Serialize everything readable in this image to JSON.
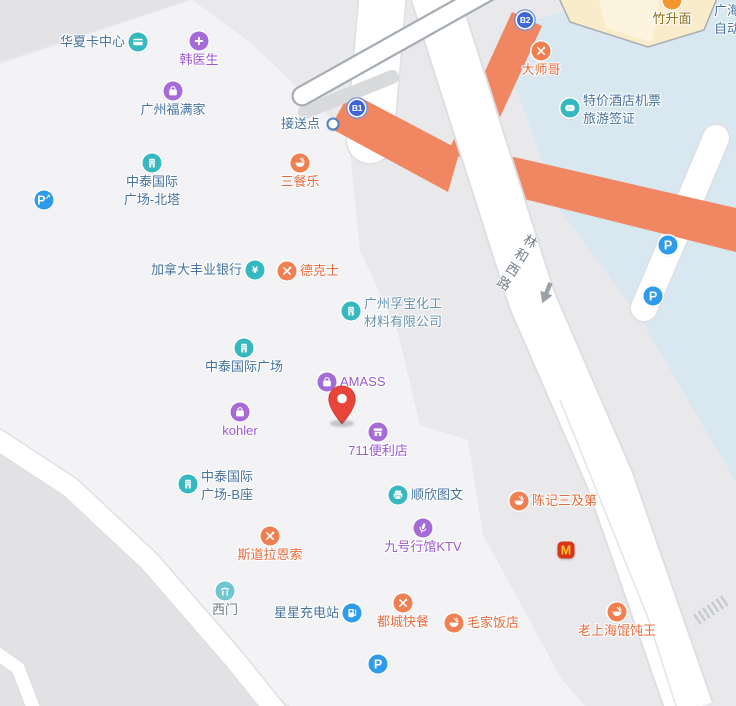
{
  "map": {
    "road_label": "林和西路",
    "theme": {
      "base": "#E9E9EB",
      "block": "#F3F3F5",
      "block_dark": "#E2E2E5",
      "corner_dark": "#E3E3E6",
      "plaza_blue": "#D9E7F0",
      "walkway_salmon": "#F08762",
      "road_fill": "#FFFFFF",
      "road_edge": "#DEDFE2",
      "elevated_edge": "#A7ADB5",
      "building_beige": "#F9ECCB",
      "building_beige_light": "#FCF4DF",
      "icon_teal": "#35B9BF",
      "icon_teal_light": "#6FC6D2",
      "icon_purple": "#A56CD9",
      "icon_orange": "#F08052",
      "icon_orange_deep": "#F5952E",
      "icon_blue": "#2E9BEB",
      "exit_blue": "#4066D4",
      "mcd_red": "#DB3418",
      "mcd_yellow": "#FFC72C",
      "pin_red": "#E8443A",
      "text_blue": "#44719F",
      "text_purple": "#9C57D4",
      "text_orange": "#E8693B",
      "text_gray": "#6F7980",
      "text_brown": "#8A6C1E"
    },
    "pois": [
      {
        "name": "huaxia-card-center",
        "label": "华夏卡中心",
        "icon": "card",
        "cat": "teal",
        "text": "blue",
        "x": 138,
        "y": 42,
        "pos": "left"
      },
      {
        "name": "han-doctor",
        "label": "韩医生",
        "icon": "medical-cross",
        "cat": "purple",
        "text": "purple",
        "x": 199,
        "y": 41,
        "pos": "below"
      },
      {
        "name": "fumanjia-store",
        "label": "广州福满家",
        "icon": "shopping-bag",
        "cat": "purple",
        "text": "blue",
        "x": 173,
        "y": 91,
        "pos": "below"
      },
      {
        "name": "zhongtai-plaza-north-tower",
        "label": "中泰国际",
        "label2": "广场-北塔",
        "icon": "building",
        "cat": "teal",
        "text": "blue",
        "x": 152,
        "y": 163,
        "pos": "below2"
      },
      {
        "name": "parking-ride-west",
        "icon": "parking-arrow",
        "badge": "P",
        "badge2": "↗",
        "x": 44,
        "y": 200
      },
      {
        "name": "pickup-point",
        "label": "接送点",
        "icon": "spot-dot",
        "text": "blue",
        "x": 333,
        "y": 124,
        "pos": "left"
      },
      {
        "name": "subway-exit-b1",
        "icon": "exit",
        "badge": "B1",
        "x": 357,
        "y": 108
      },
      {
        "name": "sancanle-restaurant",
        "label": "三餐乐",
        "icon": "rice-bowl",
        "cat": "orange",
        "text": "orange",
        "x": 300,
        "y": 163,
        "pos": "below"
      },
      {
        "name": "scotiabank",
        "label": "加拿大丰业银行",
        "icon": "yen",
        "cat": "teal",
        "text": "blue",
        "x": 255,
        "y": 270,
        "pos": "left"
      },
      {
        "name": "dicos",
        "label": "德克士",
        "icon": "utensils",
        "cat": "orange",
        "text": "orange",
        "x": 287,
        "y": 271,
        "pos": "right"
      },
      {
        "name": "fubao-chemical",
        "label": "广州孚宝化工",
        "label2": "材料有限公司",
        "icon": "building",
        "cat": "teal",
        "text": "lightblue",
        "x": 351,
        "y": 311,
        "pos": "right2"
      },
      {
        "name": "zhongtai-plaza",
        "label": "中泰国际广场",
        "icon": "building",
        "cat": "teal",
        "text": "blue",
        "x": 244,
        "y": 348,
        "pos": "below"
      },
      {
        "name": "amass-store",
        "label": "AMASS",
        "icon": "shopping-bag",
        "cat": "purple",
        "text": "purple",
        "x": 327,
        "y": 382,
        "pos": "right"
      },
      {
        "name": "location-pin",
        "icon": "pin",
        "x": 342,
        "y": 407
      },
      {
        "name": "kohler-store",
        "label": "kohler",
        "icon": "shopping-bag",
        "cat": "purple",
        "text": "purple",
        "x": 240,
        "y": 412,
        "pos": "below"
      },
      {
        "name": "store-711",
        "label": "711便利店",
        "icon": "storefront",
        "cat": "purple",
        "text": "purple",
        "x": 378,
        "y": 432,
        "pos": "below"
      },
      {
        "name": "zhongtai-plaza-tower-b",
        "label": "中泰国际",
        "label2": "广场-B座",
        "icon": "building",
        "cat": "teal",
        "text": "blue",
        "x": 188,
        "y": 484,
        "pos": "right2"
      },
      {
        "name": "shunxin-print-shop",
        "label": "顺欣图文",
        "icon": "printer",
        "cat": "teal",
        "text": "blue",
        "x": 398,
        "y": 495,
        "pos": "right"
      },
      {
        "name": "chenji-restaurant",
        "label": "陈记三及第",
        "icon": "rice-bowl",
        "cat": "orange",
        "text": "orange",
        "x": 519,
        "y": 501,
        "pos": "right"
      },
      {
        "name": "stora-enso-restaurant",
        "label": "斯道拉恩索",
        "icon": "utensils",
        "cat": "orange",
        "text": "orange",
        "x": 270,
        "y": 536,
        "pos": "below"
      },
      {
        "name": "ktv-no9-hall",
        "label": "九号行馆KTV",
        "icon": "microphone",
        "cat": "purple",
        "text": "purple",
        "x": 423,
        "y": 528,
        "pos": "below"
      },
      {
        "name": "mcdonalds",
        "icon": "mcdonalds",
        "badge": "M",
        "x": 566,
        "y": 550
      },
      {
        "name": "west-gate",
        "label": "西门",
        "icon": "gate",
        "cat": "tealLight",
        "text": "gray",
        "x": 225,
        "y": 591,
        "pos": "below"
      },
      {
        "name": "xingxing-charging-station",
        "label": "星星充电站",
        "icon": "ev-charger",
        "cat": "blue",
        "text": "blue",
        "x": 352,
        "y": 613,
        "pos": "left"
      },
      {
        "name": "ducheng-fastfood",
        "label": "都城快餐",
        "icon": "utensils",
        "cat": "orange",
        "text": "orange",
        "x": 403,
        "y": 603,
        "pos": "below"
      },
      {
        "name": "maojia-restaurant",
        "label": "毛家饭店",
        "icon": "rice-bowl",
        "cat": "orange",
        "text": "orange",
        "x": 454,
        "y": 623,
        "pos": "right"
      },
      {
        "name": "parking-south",
        "icon": "parking",
        "badge": "P",
        "x": 378,
        "y": 664
      },
      {
        "name": "laoshanghai-wonton",
        "label": "老上海馄饨王",
        "icon": "rice-bowl",
        "cat": "orange",
        "text": "orange",
        "x": 617,
        "y": 612,
        "pos": "below"
      },
      {
        "name": "dashige-restaurant",
        "label": "大师哥",
        "icon": "utensils",
        "cat": "orange",
        "text": "orange",
        "x": 541,
        "y": 51,
        "pos": "below"
      },
      {
        "name": "subway-exit-b2",
        "icon": "exit",
        "badge": "B2",
        "x": 525,
        "y": 20
      },
      {
        "name": "tejia-hotel-flight-tickets",
        "label": "特价酒店机票",
        "label2": "旅游签证",
        "icon": "ticket",
        "cat": "teal",
        "text": "blue",
        "x": 570,
        "y": 108,
        "pos": "right2"
      },
      {
        "name": "zhushengmian-noodles",
        "label": "竹升面",
        "icon": "noodle",
        "cat": "orangeDeep",
        "text": "brown",
        "x": 672,
        "y": 0,
        "pos": "below"
      },
      {
        "name": "guanghai-auto-label",
        "label": "广海",
        "label2": "自动",
        "text": "blue",
        "x": 714,
        "y": 9,
        "pos": "edge2"
      },
      {
        "name": "parking-northeast",
        "icon": "parking",
        "badge": "P",
        "x": 668,
        "y": 245
      },
      {
        "name": "parking-east",
        "icon": "parking",
        "badge": "P",
        "x": 653,
        "y": 296
      }
    ]
  }
}
